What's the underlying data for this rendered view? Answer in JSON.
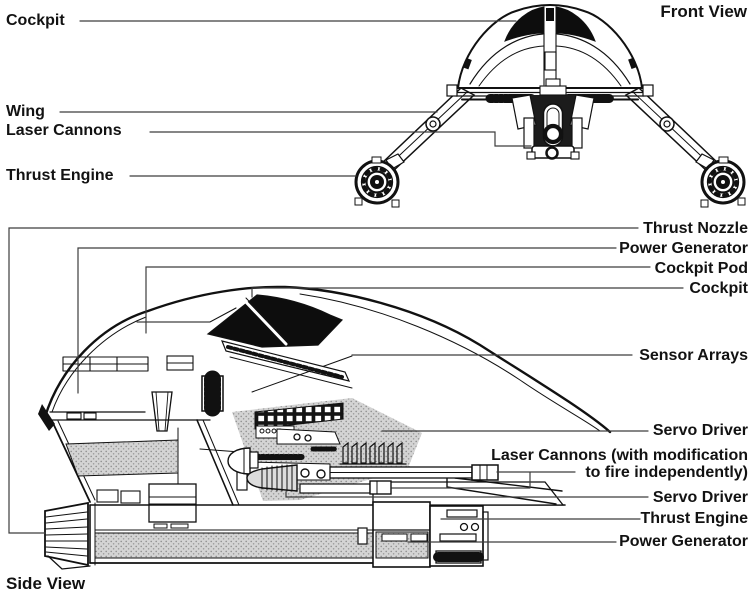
{
  "front_view": {
    "title": "Front View",
    "labels": {
      "cockpit": "Cockpit",
      "wing": "Wing",
      "laser_cannons": "Laser Cannons",
      "thrust_engine": "Thrust Engine"
    }
  },
  "side_view": {
    "title": "Side View",
    "labels": {
      "thrust_nozzle": "Thrust Nozzle",
      "power_generator_top": "Power Generator",
      "cockpit_pod": "Cockpit Pod",
      "cockpit": "Cockpit",
      "sensor_arrays": "Sensor Arrays",
      "servo_driver_upper": "Servo Driver",
      "laser_cannons_lines": [
        "Laser Cannons (with modification",
        "to fire independently)"
      ],
      "servo_driver_lower": "Servo Driver",
      "thrust_engine": "Thrust Engine",
      "power_generator_bottom": "Power Generator"
    }
  },
  "colors": {
    "background": "#ffffff",
    "ink": "#111111",
    "leader_line": "#3d3d3d",
    "canopy": "#0d0d0d",
    "shading_gray": "#d4d4d4"
  }
}
